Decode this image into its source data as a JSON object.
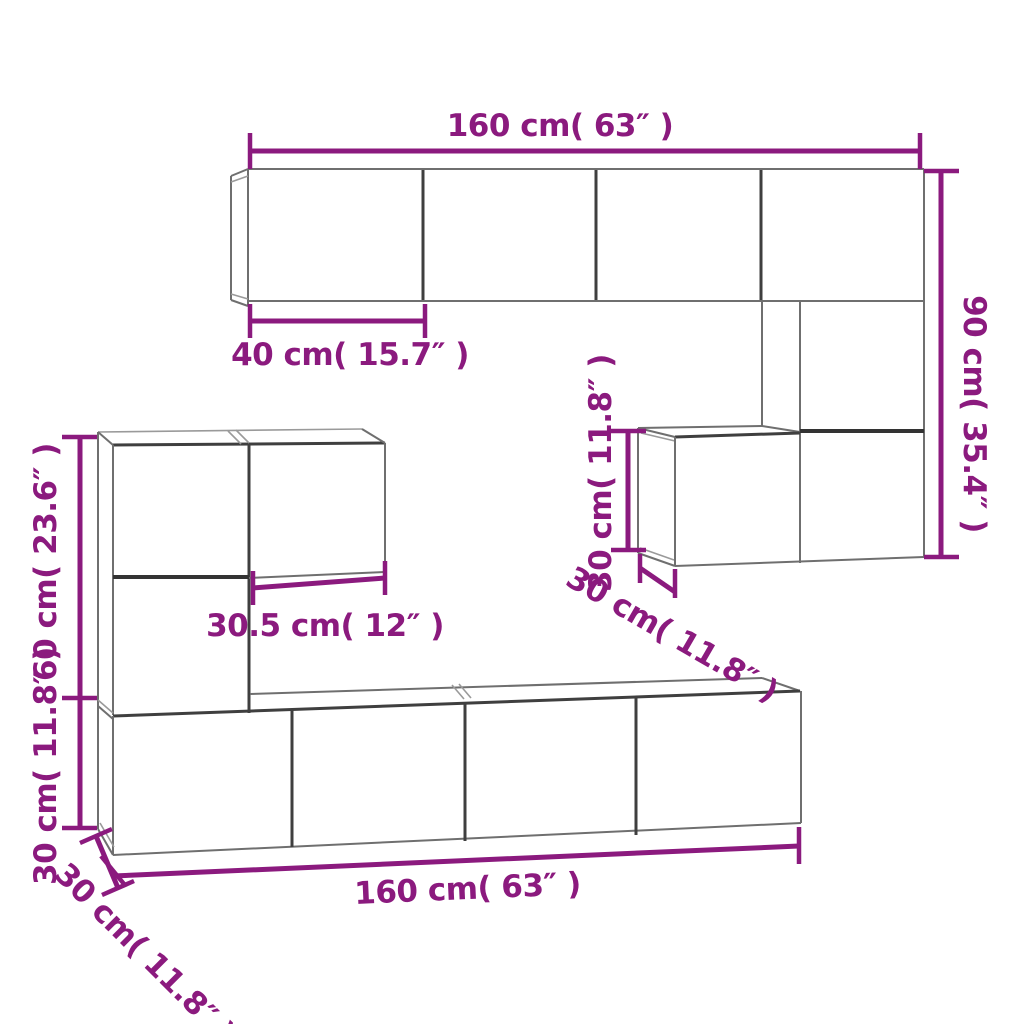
{
  "diagram": {
    "kind": "furniture dimension diagram - wall mounted TV cabinet set",
    "colors": {
      "dimension": "#8b1a7e",
      "edge": "#6f6f6f",
      "edge_dark": "#3f3f3f",
      "edge_light": "#9a9a9a",
      "background": "#ffffff"
    },
    "labels": {
      "top_width": "160 cm( 63″ )",
      "top_door_width": "40 cm( 15.7″ )",
      "right_height": "90 cm( 35.4″ )",
      "middle_cabinet_height": "30 cm( 11.8″ )",
      "middle_cabinet_depth": "30 cm( 11.8″ )",
      "left_unit_height": "60 cm( 23.6″ )",
      "left_lower_cabinet_height": "30 cm( 11.8″ )",
      "left_cabinet_width": "30.5 cm( 12″ )",
      "bottom_width": "160 cm( 63″ )",
      "bottom_depth": "30 cm( 11.8″ )"
    }
  }
}
